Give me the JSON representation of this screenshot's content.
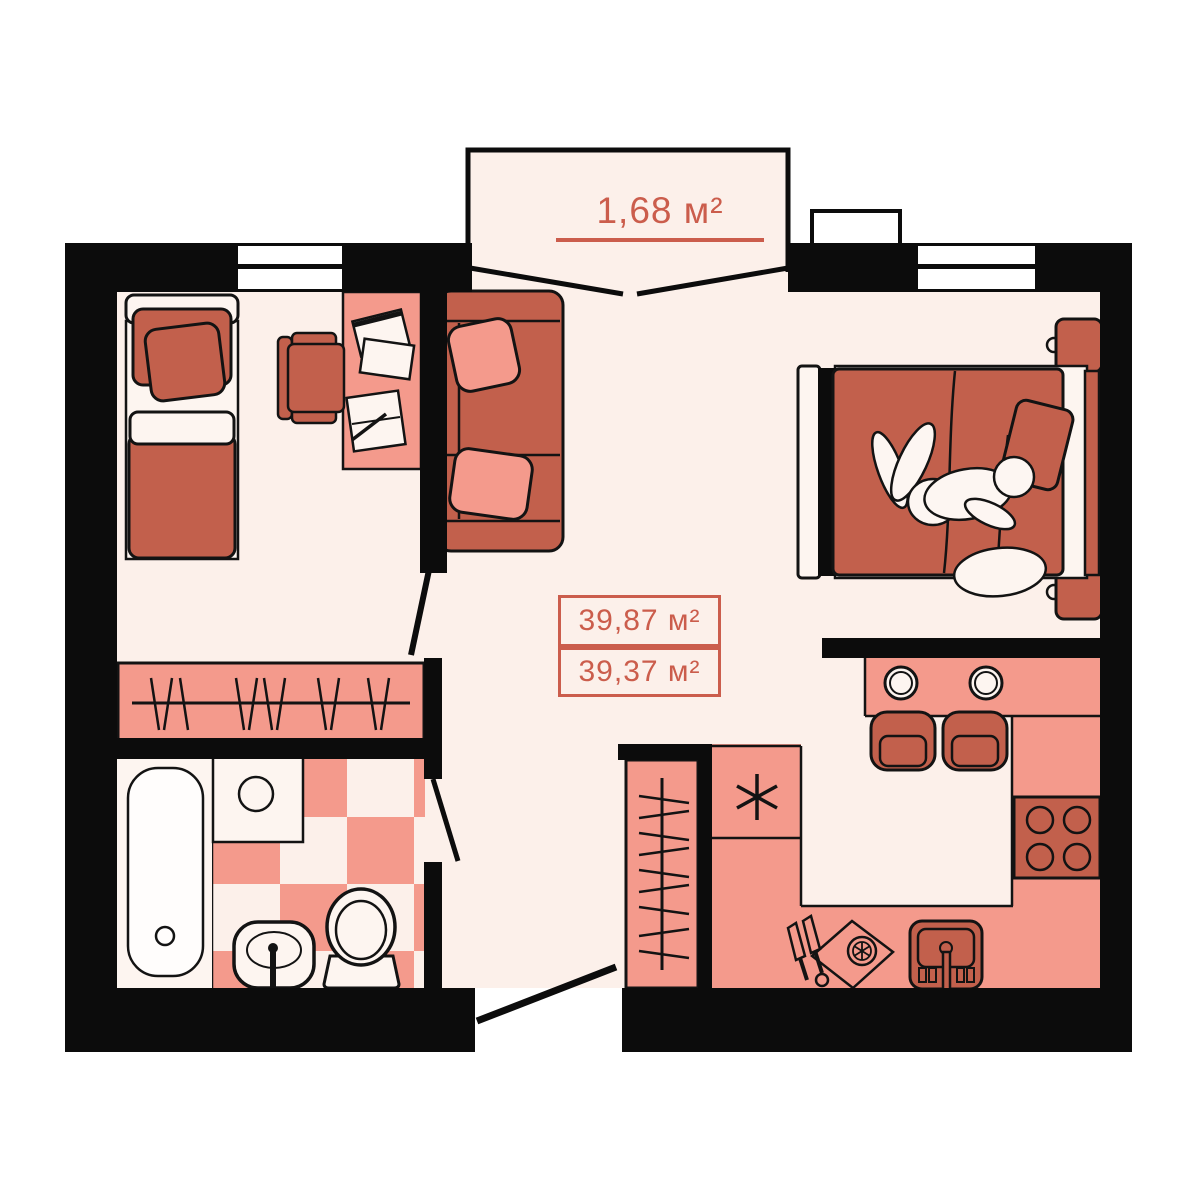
{
  "document": {
    "type": "apartment-floor-plan",
    "background": "#ffffff"
  },
  "palette": {
    "floor": "#fcf0ea",
    "fixture_light": "#fdf5f0",
    "furniture_salmon": "#f49a8c",
    "furniture_dark_salmon": "#c2604c",
    "wall_black": "#0c0c0c",
    "accent_text": "#cb5d4c",
    "outline": "#131313"
  },
  "labels": {
    "balcony_area": "1,68 м²",
    "total_area": "39,87 м²",
    "living_area": "39,37 м²"
  },
  "icons": {
    "fridge_marker": "six-point-asterisk"
  }
}
